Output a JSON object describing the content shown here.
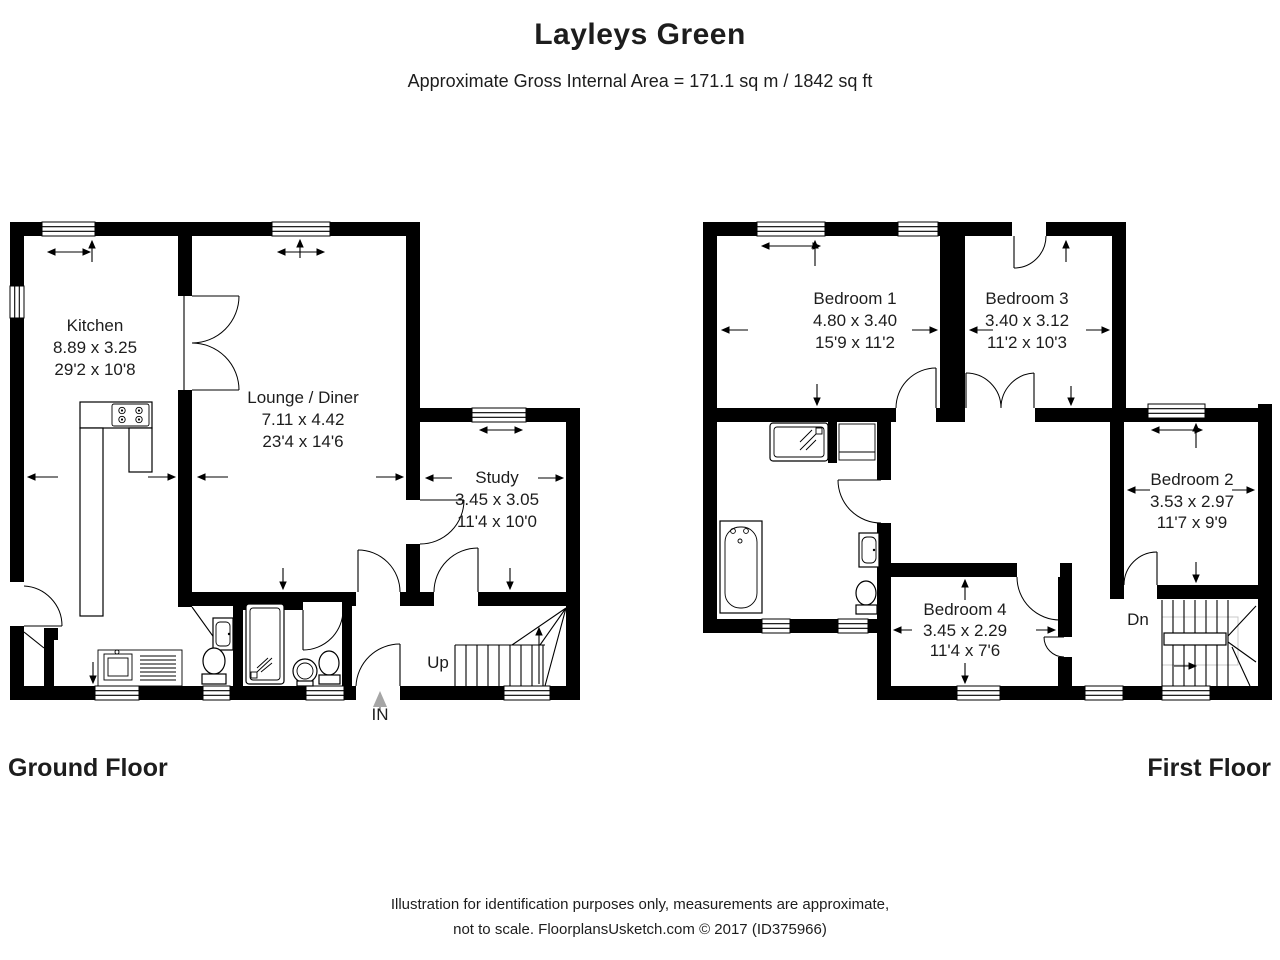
{
  "header": {
    "title": "Layleys Green",
    "subtitle": "Approximate Gross Internal Area = 171.1 sq m / 1842 sq ft"
  },
  "ground_floor": {
    "label": "Ground Floor",
    "rooms": {
      "kitchen": {
        "name": "Kitchen",
        "metric": "8.89 x 3.25",
        "imperial": "29'2 x 10'8"
      },
      "lounge_diner": {
        "name": "Lounge / Diner",
        "metric": "7.11 x 4.42",
        "imperial": "23'4 x 14'6"
      },
      "study": {
        "name": "Study",
        "metric": "3.45 x 3.05",
        "imperial": "11'4 x 10'0"
      }
    },
    "stairs_label": "Up",
    "entrance_label": "IN"
  },
  "first_floor": {
    "label": "First Floor",
    "rooms": {
      "bedroom1": {
        "name": "Bedroom 1",
        "metric": "4.80 x 3.40",
        "imperial": "15'9 x 11'2"
      },
      "bedroom3": {
        "name": "Bedroom 3",
        "metric": "3.40 x 3.12",
        "imperial": "11'2 x 10'3"
      },
      "bedroom2": {
        "name": "Bedroom 2",
        "metric": "3.53 x 2.97",
        "imperial": "11'7 x 9'9"
      },
      "bedroom4": {
        "name": "Bedroom 4",
        "metric": "3.45 x 2.29",
        "imperial": "11'4 x 7'6"
      }
    },
    "stairs_label": "Dn"
  },
  "footer": {
    "line1": "Illustration for identification purposes only, measurements are approximate,",
    "line2": "not to scale. FloorplansUsketch.com © 2017 (ID375966)"
  },
  "colors": {
    "walls": "#000000",
    "background": "#ffffff",
    "label_text": "#1d1d1d",
    "entry_arrow": "#a6a6a6",
    "stair_void": "#c9c9c9"
  }
}
